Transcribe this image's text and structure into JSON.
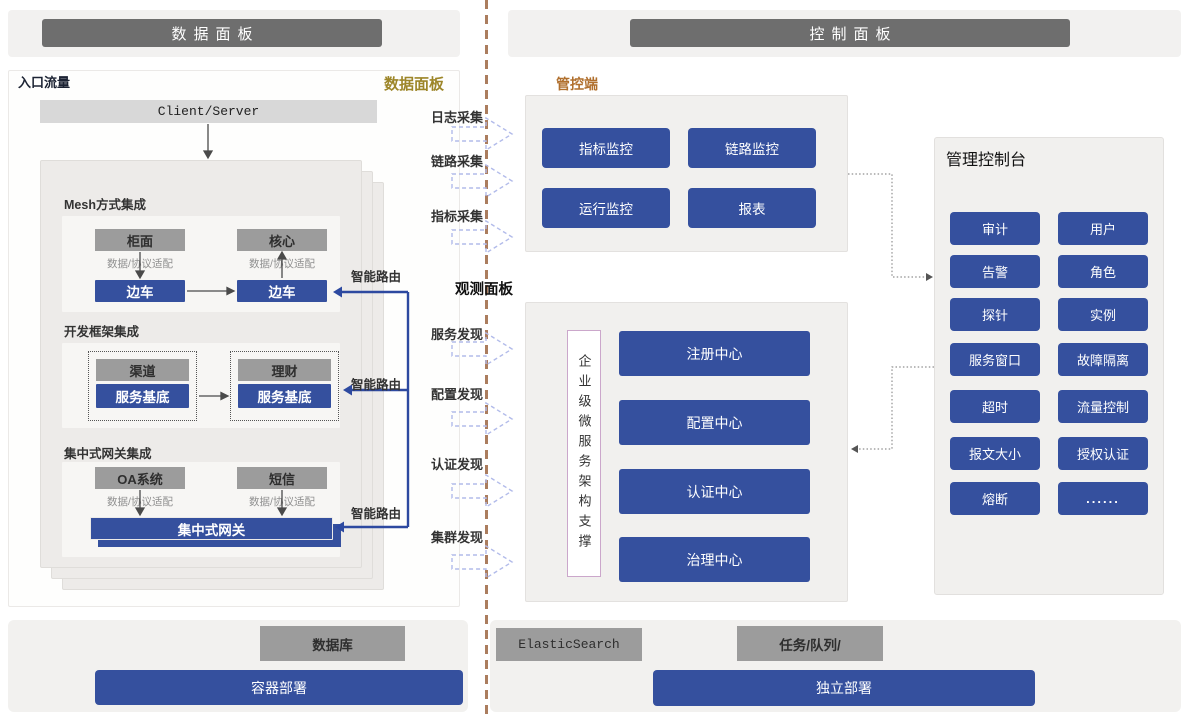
{
  "headers": {
    "left": "数据面板",
    "right": "控制面板"
  },
  "data_panel": {
    "corner_label": "入口流量",
    "panel_label": "数据面板",
    "client_server": "Client/Server",
    "adapter_label": "数据/协议适配",
    "smart_route": "智能路由",
    "mesh": {
      "title": "Mesh方式集成",
      "left_top": "柜面",
      "right_top": "核心",
      "left_bottom": "边车",
      "right_bottom": "边车"
    },
    "framework": {
      "title": "开发框架集成",
      "left_top": "渠道",
      "right_top": "理财",
      "left_bottom": "服务基底",
      "right_bottom": "服务基底"
    },
    "gateway_sec": {
      "title": "集中式网关集成",
      "left_top": "OA系统",
      "right_top": "短信",
      "gateway": "集中式网关"
    }
  },
  "middle": {
    "collect": [
      "日志采集",
      "链路采集",
      "指标采集"
    ],
    "observe_label": "观测面板",
    "discover": [
      "服务发现",
      "配置发现",
      "认证发现",
      "集群发现"
    ]
  },
  "control": {
    "tag": "管控端",
    "monitors": [
      "指标监控",
      "链路监控",
      "运行监控",
      "报表"
    ],
    "support": "企业级微服务架构支撑",
    "centers": [
      "注册中心",
      "配置中心",
      "认证中心",
      "治理中心"
    ],
    "console": {
      "title": "管理控制台",
      "rows": [
        [
          "审计",
          "用户"
        ],
        [
          "告警",
          "角色"
        ],
        [
          "探针",
          "实例"
        ],
        [
          "服务窗口",
          "故障隔离"
        ],
        [
          "超时",
          "流量控制"
        ],
        [
          "报文大小",
          "授权认证"
        ],
        [
          "熔断",
          "......"
        ]
      ]
    }
  },
  "bottom": {
    "db": "数据库",
    "es": "ElasticSearch",
    "queue": "任务/队列/",
    "deploy_left": "容器部署",
    "deploy_right": "独立部署"
  },
  "colors": {
    "primary_blue": "#35509e",
    "header_gray": "#6e6e6e",
    "box_gray": "#9c9c9c",
    "gold_label": "#9d8629",
    "orange_label": "#b06f2d",
    "divider_brown": "#ab7d5e",
    "dashed_arrow_blue": "#b2bbea"
  }
}
